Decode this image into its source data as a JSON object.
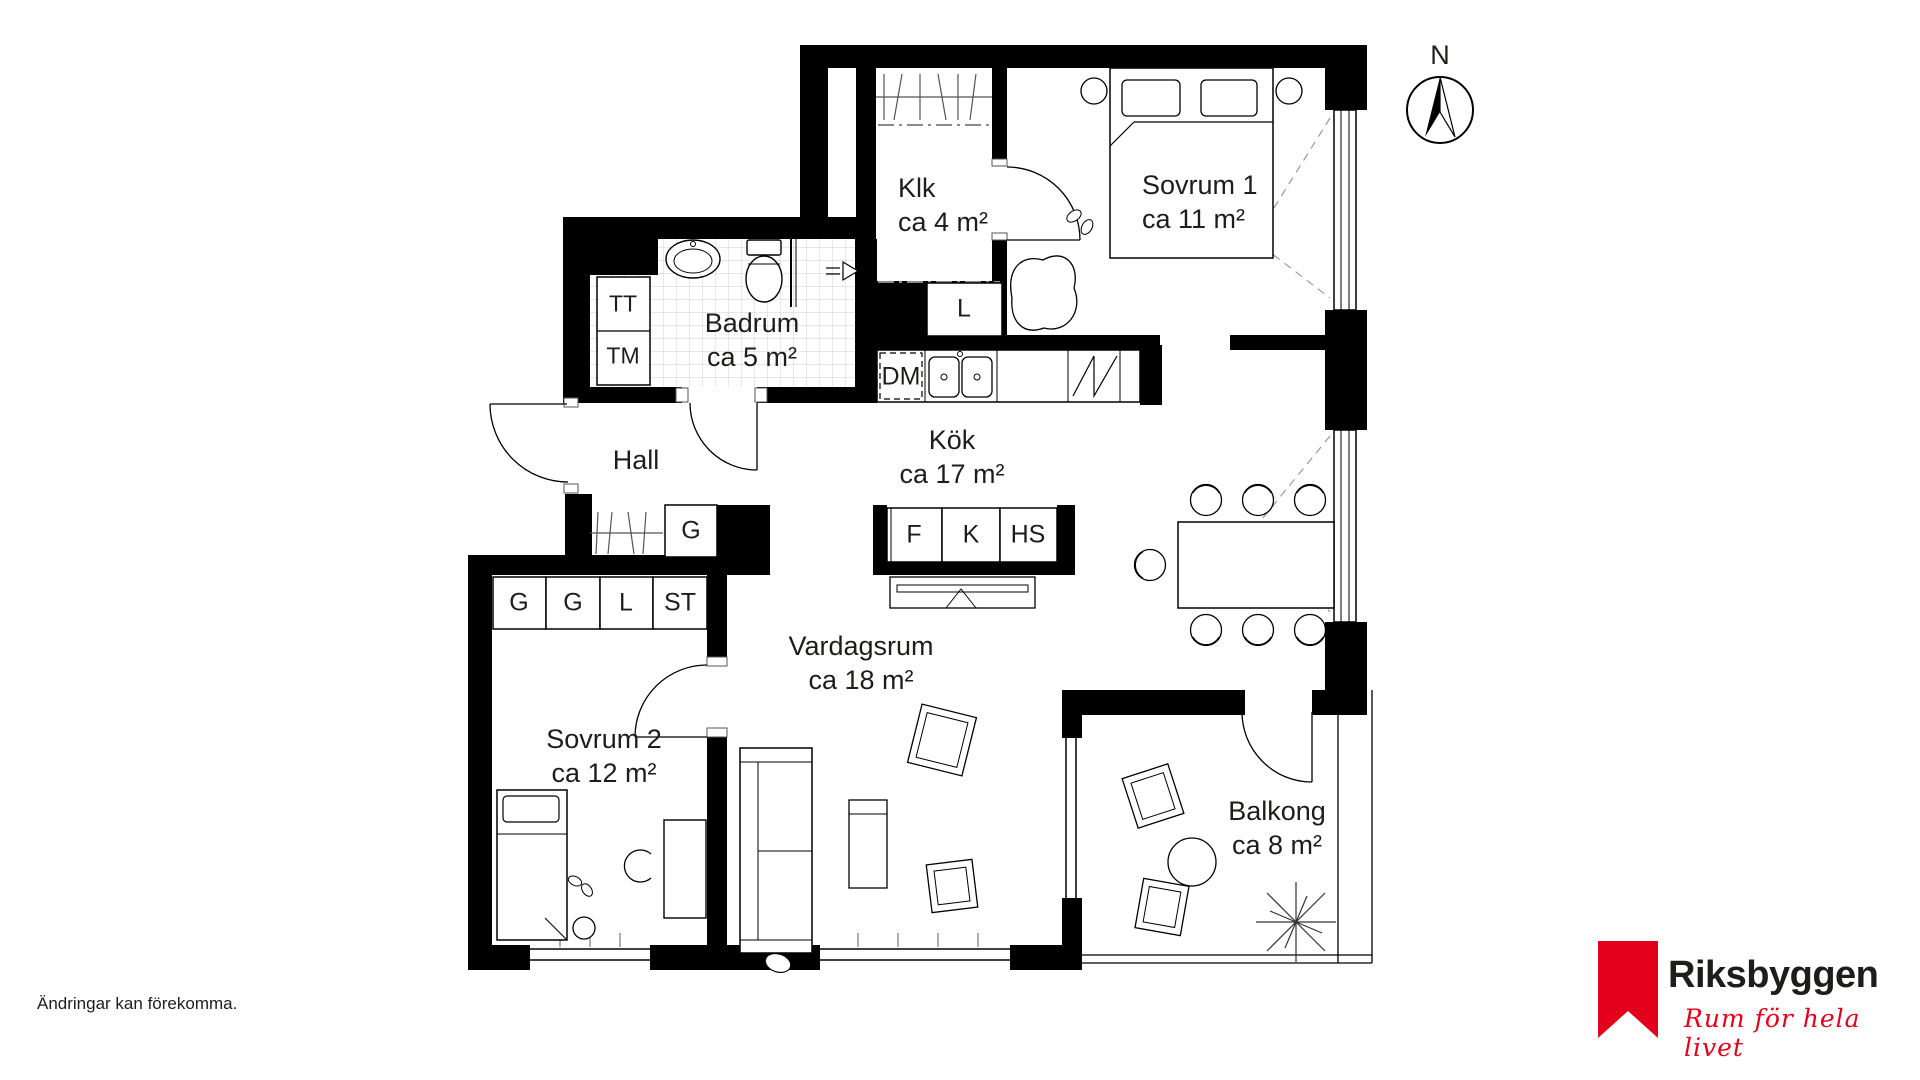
{
  "rooms": {
    "klk": {
      "name": "Klk",
      "area": "ca 4 m²"
    },
    "sovrum1": {
      "name": "Sovrum 1",
      "area": "ca 11 m²"
    },
    "badrum": {
      "name": "Badrum",
      "area": "ca 5 m²"
    },
    "hall": {
      "name": "Hall"
    },
    "kok": {
      "name": "Kök",
      "area": "ca 17 m²"
    },
    "vardagsrum": {
      "name": "Vardagsrum",
      "area": "ca 18 m²"
    },
    "sovrum2": {
      "name": "Sovrum 2",
      "area": "ca 12 m²"
    },
    "balkong": {
      "name": "Balkong",
      "area": "ca 8 m²"
    }
  },
  "fixtures": {
    "linen_closet": "L",
    "dishwasher": "DM",
    "dryer": "TT",
    "washer": "TM",
    "hall_wardrobe": "G",
    "bedroom2_wardrobes": [
      "G",
      "G",
      "L",
      "ST"
    ],
    "kitchen_tall_units": [
      "F",
      "K",
      "HS"
    ]
  },
  "compass": {
    "north_label": "N"
  },
  "footer": {
    "disclaimer": "Ändringar kan förekomma."
  },
  "brand": {
    "name": "Riksbyggen",
    "tagline": "Rum för hela livet",
    "red": "#e2001a"
  },
  "colors": {
    "wall": "#000000",
    "line": "#1d1d1b",
    "tile_grid": "#cfcfcf",
    "dash": "#8a8a8a"
  }
}
